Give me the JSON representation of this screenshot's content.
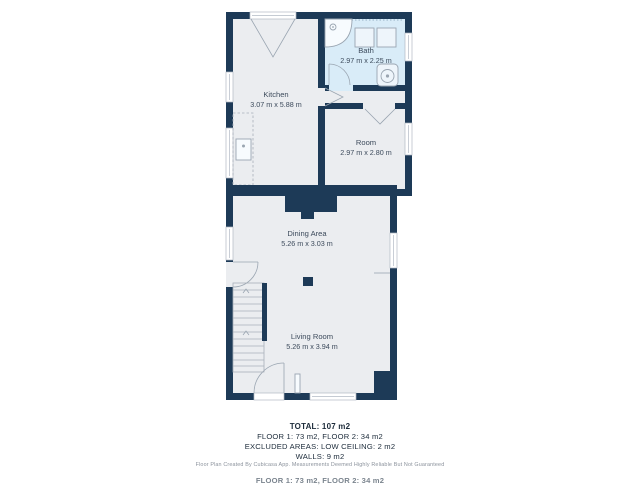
{
  "plan": {
    "rooms": [
      {
        "name": "Kitchen",
        "dims": "3.07 m x 5.88 m"
      },
      {
        "name": "Bath",
        "dims": "2.97 m x 2.25 m"
      },
      {
        "name": "Room",
        "dims": "2.97 m x 2.80 m"
      },
      {
        "name": "Dining Area",
        "dims": "5.26 m x 3.03 m"
      },
      {
        "name": "Living Room",
        "dims": "5.26 m x 3.94 m"
      }
    ],
    "colors": {
      "wall": "#1d3a57",
      "floor": "#ebedf0",
      "bath_floor": "#d9ecf8",
      "fixture": "#9aa5b1",
      "label_text": "#3d4b5c",
      "summary_text": "#1c2b3a",
      "disclaimer_text": "#8b929c"
    }
  },
  "summary": {
    "total": "TOTAL: 107 m2",
    "floors": "FLOOR 1: 73 m2, FLOOR 2: 34 m2",
    "excluded": "EXCLUDED AREAS: LOW CEILING: 2 m2",
    "walls": "WALLS: 9 m2",
    "disclaimer": "Floor Plan Created By Cubicasa App. Measurements Deemed Highly Reliable But Not Guaranteed",
    "cutoff_line": "FLOOR 1: 73 m2, FLOOR 2: 34 m2"
  }
}
